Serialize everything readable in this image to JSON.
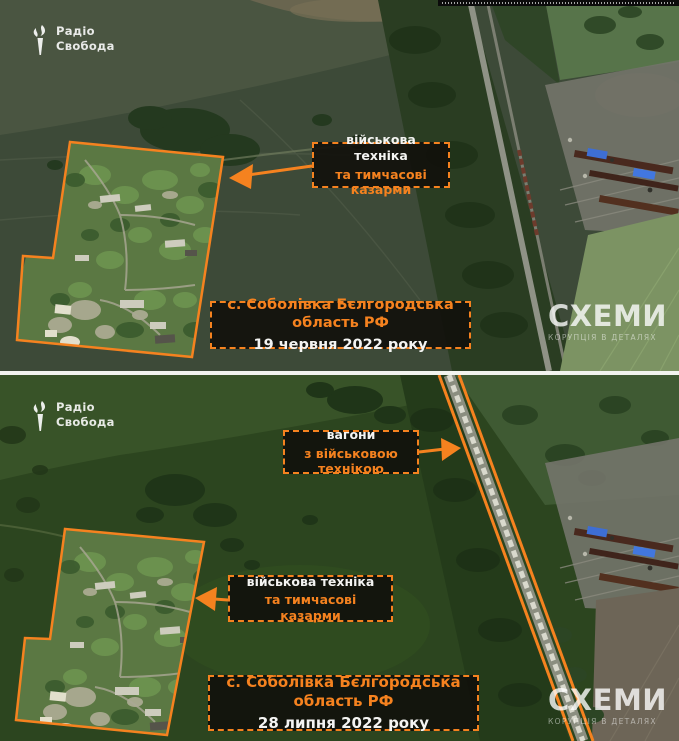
{
  "colors": {
    "accent": "#F5821F"
  },
  "branding": {
    "logo_line1": "Радіо",
    "logo_line2": "Свобода",
    "watermark_title": "СХЕМИ",
    "watermark_subtitle": "КОРУПЦІЯ В ДЕТАЛЯХ"
  },
  "top_panel": {
    "annotation": {
      "line1": "військова техніка",
      "line2": "та тимчасові казарми"
    },
    "caption": {
      "location": "с. Соболівка Бєлгородська область РФ",
      "date": "19 червня 2022 року"
    }
  },
  "bottom_panel": {
    "wagons_annotation": {
      "line1": "вагони",
      "line2": "з військовою технікою"
    },
    "annotation": {
      "line1": "військова техніка",
      "line2": "та тимчасові казарми"
    },
    "caption": {
      "location": "с. Соболівка Бєлгородська область РФ",
      "date": "28 липня 2022 року"
    }
  }
}
